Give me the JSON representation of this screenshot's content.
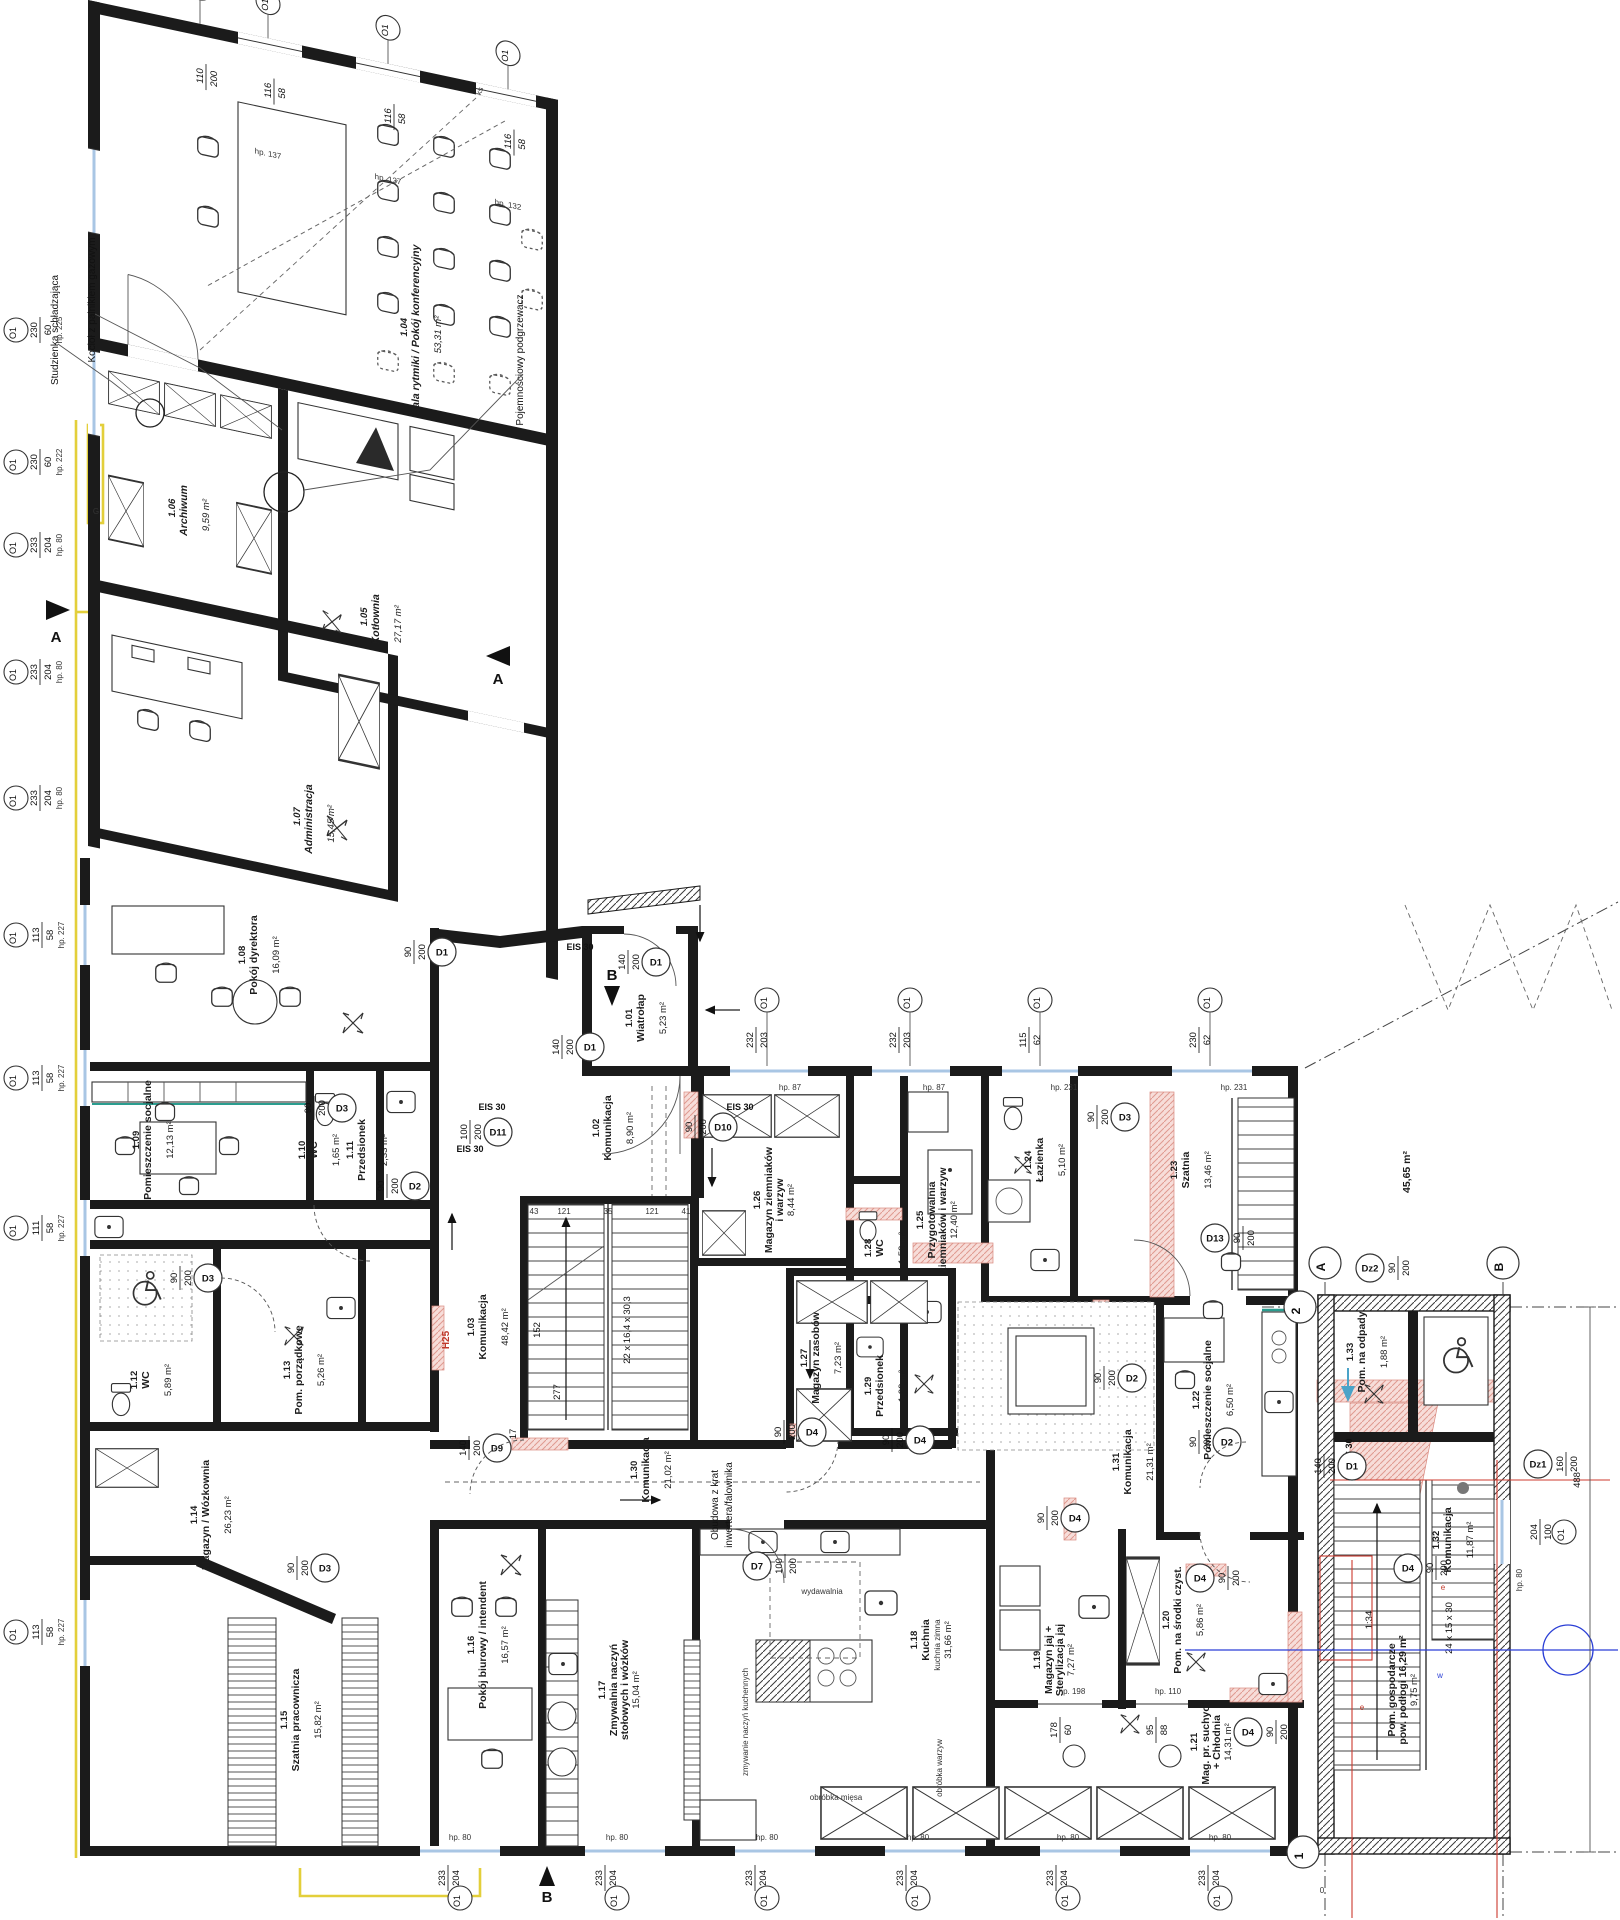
{
  "rooms": [
    {
      "num": "1.01",
      "name": "Wiatrołap",
      "name2": "",
      "area": "5,23 m²",
      "area2": ""
    },
    {
      "num": "1.02",
      "name": "Komunikacja",
      "name2": "",
      "area": "8,90 m²",
      "area2": ""
    },
    {
      "num": "1.03",
      "name": "Komunikacja",
      "name2": "",
      "area": "48,42 m²",
      "area2": ""
    },
    {
      "num": "1.04",
      "name": "Sala rytmiki / Pokój konferencyjny",
      "name2": "",
      "area": "53,31 m²",
      "area2": ""
    },
    {
      "num": "1.05",
      "name": "Kotłownia",
      "name2": "",
      "area": "27,17 m²",
      "area2": ""
    },
    {
      "num": "1.06",
      "name": "Archiwum",
      "name2": "",
      "area": "9,59 m²",
      "area2": ""
    },
    {
      "num": "1.07",
      "name": "Administracja",
      "name2": "",
      "area": "15,45 m²",
      "area2": ""
    },
    {
      "num": "1.08",
      "name": "Pokój dyrektora",
      "name2": "",
      "area": "16,09 m²",
      "area2": ""
    },
    {
      "num": "1.09",
      "name": "Pomieszczenie socjalne",
      "name2": "",
      "area": "12,13 m²",
      "area2": ""
    },
    {
      "num": "1.10",
      "name": "WC",
      "name2": "",
      "area": "1,65 m²",
      "area2": ""
    },
    {
      "num": "1.11",
      "name": "Przedsionek",
      "name2": "",
      "area": "2,33 m²",
      "area2": ""
    },
    {
      "num": "1.12",
      "name": "WC",
      "name2": "",
      "area": "5,89 m²",
      "area2": ""
    },
    {
      "num": "1.13",
      "name": "Pom. porządkowe",
      "name2": "",
      "area": "5,26 m²",
      "area2": ""
    },
    {
      "num": "1.14",
      "name": "Magazyn / Wózkownia",
      "name2": "",
      "area": "26,23 m²",
      "area2": ""
    },
    {
      "num": "1.15",
      "name": "Szatnia pracownicza",
      "name2": "",
      "area": "15,82 m²",
      "area2": ""
    },
    {
      "num": "1.16",
      "name": "Pokój biurowy / intendent",
      "name2": "",
      "area": "16,57 m²",
      "area2": ""
    },
    {
      "num": "1.17",
      "name": "Zmywalnia naczyń",
      "name2": "stołowych i wózków",
      "area": "15,04 m²",
      "area2": ""
    },
    {
      "num": "1.18",
      "name": "Kuchnia",
      "name2": "",
      "area": "31,66 m²",
      "area2": ""
    },
    {
      "num": "1.19",
      "name": "Magazyn jaj +",
      "name2": "Sterylizacja jaj",
      "area": "7,27 m²",
      "area2": ""
    },
    {
      "num": "1.20",
      "name": "Pom. na środki czyst.",
      "name2": "",
      "area": "5,86 m²",
      "area2": ""
    },
    {
      "num": "1.21",
      "name": "Mag. pr. suchych",
      "name2": "+ Chłodnia",
      "area": "14,31 m²",
      "area2": ""
    },
    {
      "num": "1.22",
      "name": "Pomieszczenie socjalne",
      "name2": "",
      "area": "6,50 m²",
      "area2": ""
    },
    {
      "num": "1.23",
      "name": "Szatnia",
      "name2": "",
      "area": "13,46 m²",
      "area2": ""
    },
    {
      "num": "1.24",
      "name": "Łazienka",
      "name2": "",
      "area": "5,10 m²",
      "area2": ""
    },
    {
      "num": "1.25",
      "name": "Przygotowalnia",
      "name2": "ziemniaków i warzyw",
      "area": "12,40 m²",
      "area2": ""
    },
    {
      "num": "1.26",
      "name": "Magazyn ziemniaków",
      "name2": "i warzyw",
      "area": "8,44 m²",
      "area2": ""
    },
    {
      "num": "1.27",
      "name": "Magazyn zasobów",
      "name2": "",
      "area": "7,23 m²",
      "area2": ""
    },
    {
      "num": "1.28",
      "name": "WC",
      "name2": "",
      "area": "1,53 m²",
      "area2": ""
    },
    {
      "num": "1.29",
      "name": "Przedsionek",
      "name2": "",
      "area": "1,90 m²",
      "area2": ""
    },
    {
      "num": "1.30",
      "name": "Komunikacja",
      "name2": "",
      "area": "21,02 m²",
      "area2": ""
    },
    {
      "num": "1.31",
      "name": "Komunikacja",
      "name2": "",
      "area": "21,31 m²",
      "area2": ""
    },
    {
      "num": "1.32",
      "name": "Komunikacja",
      "name2": "",
      "area": "11,87 m²",
      "area2": ""
    },
    {
      "num": "1.33",
      "name": "Pom. na odpady",
      "name2": "",
      "area": "1,88 m²",
      "area2": ""
    },
    {
      "num": "",
      "name": "Pom. gospodarcze",
      "name2": "pow. podłogi 16,29 m²",
      "area": "9,75 m²",
      "area2": ""
    }
  ],
  "win": [
    {
      "w": "230",
      "h": "60",
      "hp": "hp. 225",
      "c": "O1"
    },
    {
      "w": "230",
      "h": "60",
      "hp": "hp. 222",
      "c": "O1"
    },
    {
      "w": "233",
      "h": "204",
      "hp": "hp. 80",
      "c": "O1"
    },
    {
      "w": "233",
      "h": "204",
      "hp": "hp. 80",
      "c": "O1"
    },
    {
      "w": "233",
      "h": "204",
      "hp": "hp. 80",
      "c": "O1"
    },
    {
      "w": "113",
      "h": "58",
      "hp": "hp. 227",
      "c": "O1"
    },
    {
      "w": "113",
      "h": "58",
      "hp": "hp. 227",
      "c": "O1"
    },
    {
      "w": "111",
      "h": "58",
      "hp": "hp. 227",
      "c": "O1"
    },
    {
      "w": "113",
      "h": "58",
      "hp": "hp. 227",
      "c": "O1"
    },
    {
      "w": "232",
      "h": "203",
      "hp": "hp. 87",
      "c": "O1"
    },
    {
      "w": "232",
      "h": "203",
      "hp": "hp. 87",
      "c": "O1"
    },
    {
      "w": "115",
      "h": "62",
      "hp": "hp. 231",
      "c": "O1"
    },
    {
      "w": "230",
      "h": "62",
      "hp": "hp. 231",
      "c": "O1"
    },
    {
      "w": "233",
      "h": "204",
      "hp": "hp. 80",
      "c": "O1"
    },
    {
      "w": "233",
      "h": "204",
      "hp": "hp. 80",
      "c": "O1"
    },
    {
      "w": "233",
      "h": "204",
      "hp": "hp. 80",
      "c": "O1"
    },
    {
      "w": "233",
      "h": "204",
      "hp": "hp. 80",
      "c": "O1"
    },
    {
      "w": "233",
      "h": "204",
      "hp": "hp. 80",
      "c": "O1"
    },
    {
      "w": "233",
      "h": "204",
      "hp": "hp. 80",
      "c": "O1"
    },
    {
      "w": "204",
      "h": "100",
      "hp": "hp. 80",
      "c": "O1"
    },
    {
      "w": "178",
      "h": "60",
      "hp": "hp. 198",
      "c": ""
    },
    {
      "w": "95",
      "h": "88",
      "hp": "hp. 110",
      "c": ""
    },
    {
      "w": "116",
      "h": "58",
      "hp": "hp. 137",
      "c": "O1"
    },
    {
      "w": "116",
      "h": "58",
      "hp": "hp. 137",
      "c": "O1"
    },
    {
      "w": "116",
      "h": "58",
      "hp": "hp. 132",
      "c": "O1"
    },
    {
      "w": "110",
      "h": "200",
      "hp": "",
      "c": "O1"
    }
  ],
  "doors": [
    {
      "t": "D1",
      "w": "140",
      "h": "200"
    },
    {
      "t": "D1",
      "w": "140",
      "h": "200"
    },
    {
      "t": "D10",
      "w": "90",
      "h": "200"
    },
    {
      "t": "D11",
      "w": "100",
      "h": "200"
    },
    {
      "t": "D2",
      "w": "90",
      "h": "200"
    },
    {
      "t": "D3",
      "w": "90",
      "h": "200"
    },
    {
      "t": "D3",
      "w": "90",
      "h": "200"
    },
    {
      "t": "D3",
      "w": "90",
      "h": "200"
    },
    {
      "t": "D9",
      "w": "140",
      "h": "200"
    },
    {
      "t": "D4",
      "w": "90",
      "h": "200"
    },
    {
      "t": "D4",
      "w": "90",
      "h": "200"
    },
    {
      "t": "D4",
      "w": "90",
      "h": "200"
    },
    {
      "t": "D4",
      "w": "90",
      "h": "200"
    },
    {
      "t": "D7",
      "w": "100",
      "h": "200"
    },
    {
      "t": "D2",
      "w": "90",
      "h": "200"
    },
    {
      "t": "D2",
      "w": "90",
      "h": "200"
    },
    {
      "t": "D13",
      "w": "90",
      "h": "200"
    },
    {
      "t": "D3",
      "w": "90",
      "h": "200"
    },
    {
      "t": "D4",
      "w": "90",
      "h": "200"
    },
    {
      "t": "Dz2",
      "w": "90",
      "h": "200"
    },
    {
      "t": "Dz1",
      "w": "160",
      "h": "200"
    },
    {
      "t": "D1",
      "w": "140",
      "h": "200"
    },
    {
      "t": "D4",
      "w": "90",
      "h": "200"
    },
    {
      "t": "D1",
      "w": "90",
      "h": "200"
    }
  ],
  "grid": {
    "a": "A",
    "b": "B",
    "n1": "1",
    "n2": "2"
  },
  "sections": {
    "sa": "A",
    "sb": "B"
  },
  "stairs": {
    "main_spec": "22 x 16,4 x 30,3",
    "annex_spec": "24 x 15 x 30",
    "slope": "1:34",
    "d152": "152",
    "d277": "277",
    "d17": "17",
    "t1": "43",
    "t2": "121",
    "t3": "35",
    "t4": "121",
    "t5": "41"
  },
  "annot": {
    "stud": "Studzienka schładzająca",
    "kociol": "Kocioł z palnikiem gazowym",
    "pojem": "Pojemnościowy podgrzewacz",
    "obud1": "Obudowa z krat",
    "obud2": "inwertera/falownika",
    "area45": "45,65 m²",
    "h25": "H25",
    "wyd": "wydawalnia",
    "kz": "kuchnia zimna",
    "ow": "obróbka warzyw",
    "om": "obróbka mięsa",
    "zn": "zmywanie naczyń kuchennych",
    "eis": "EIS 30",
    "ks": "ks",
    "e": "e",
    "wmark": "w",
    "g": "G",
    "zero": "0",
    "d488": "488"
  }
}
